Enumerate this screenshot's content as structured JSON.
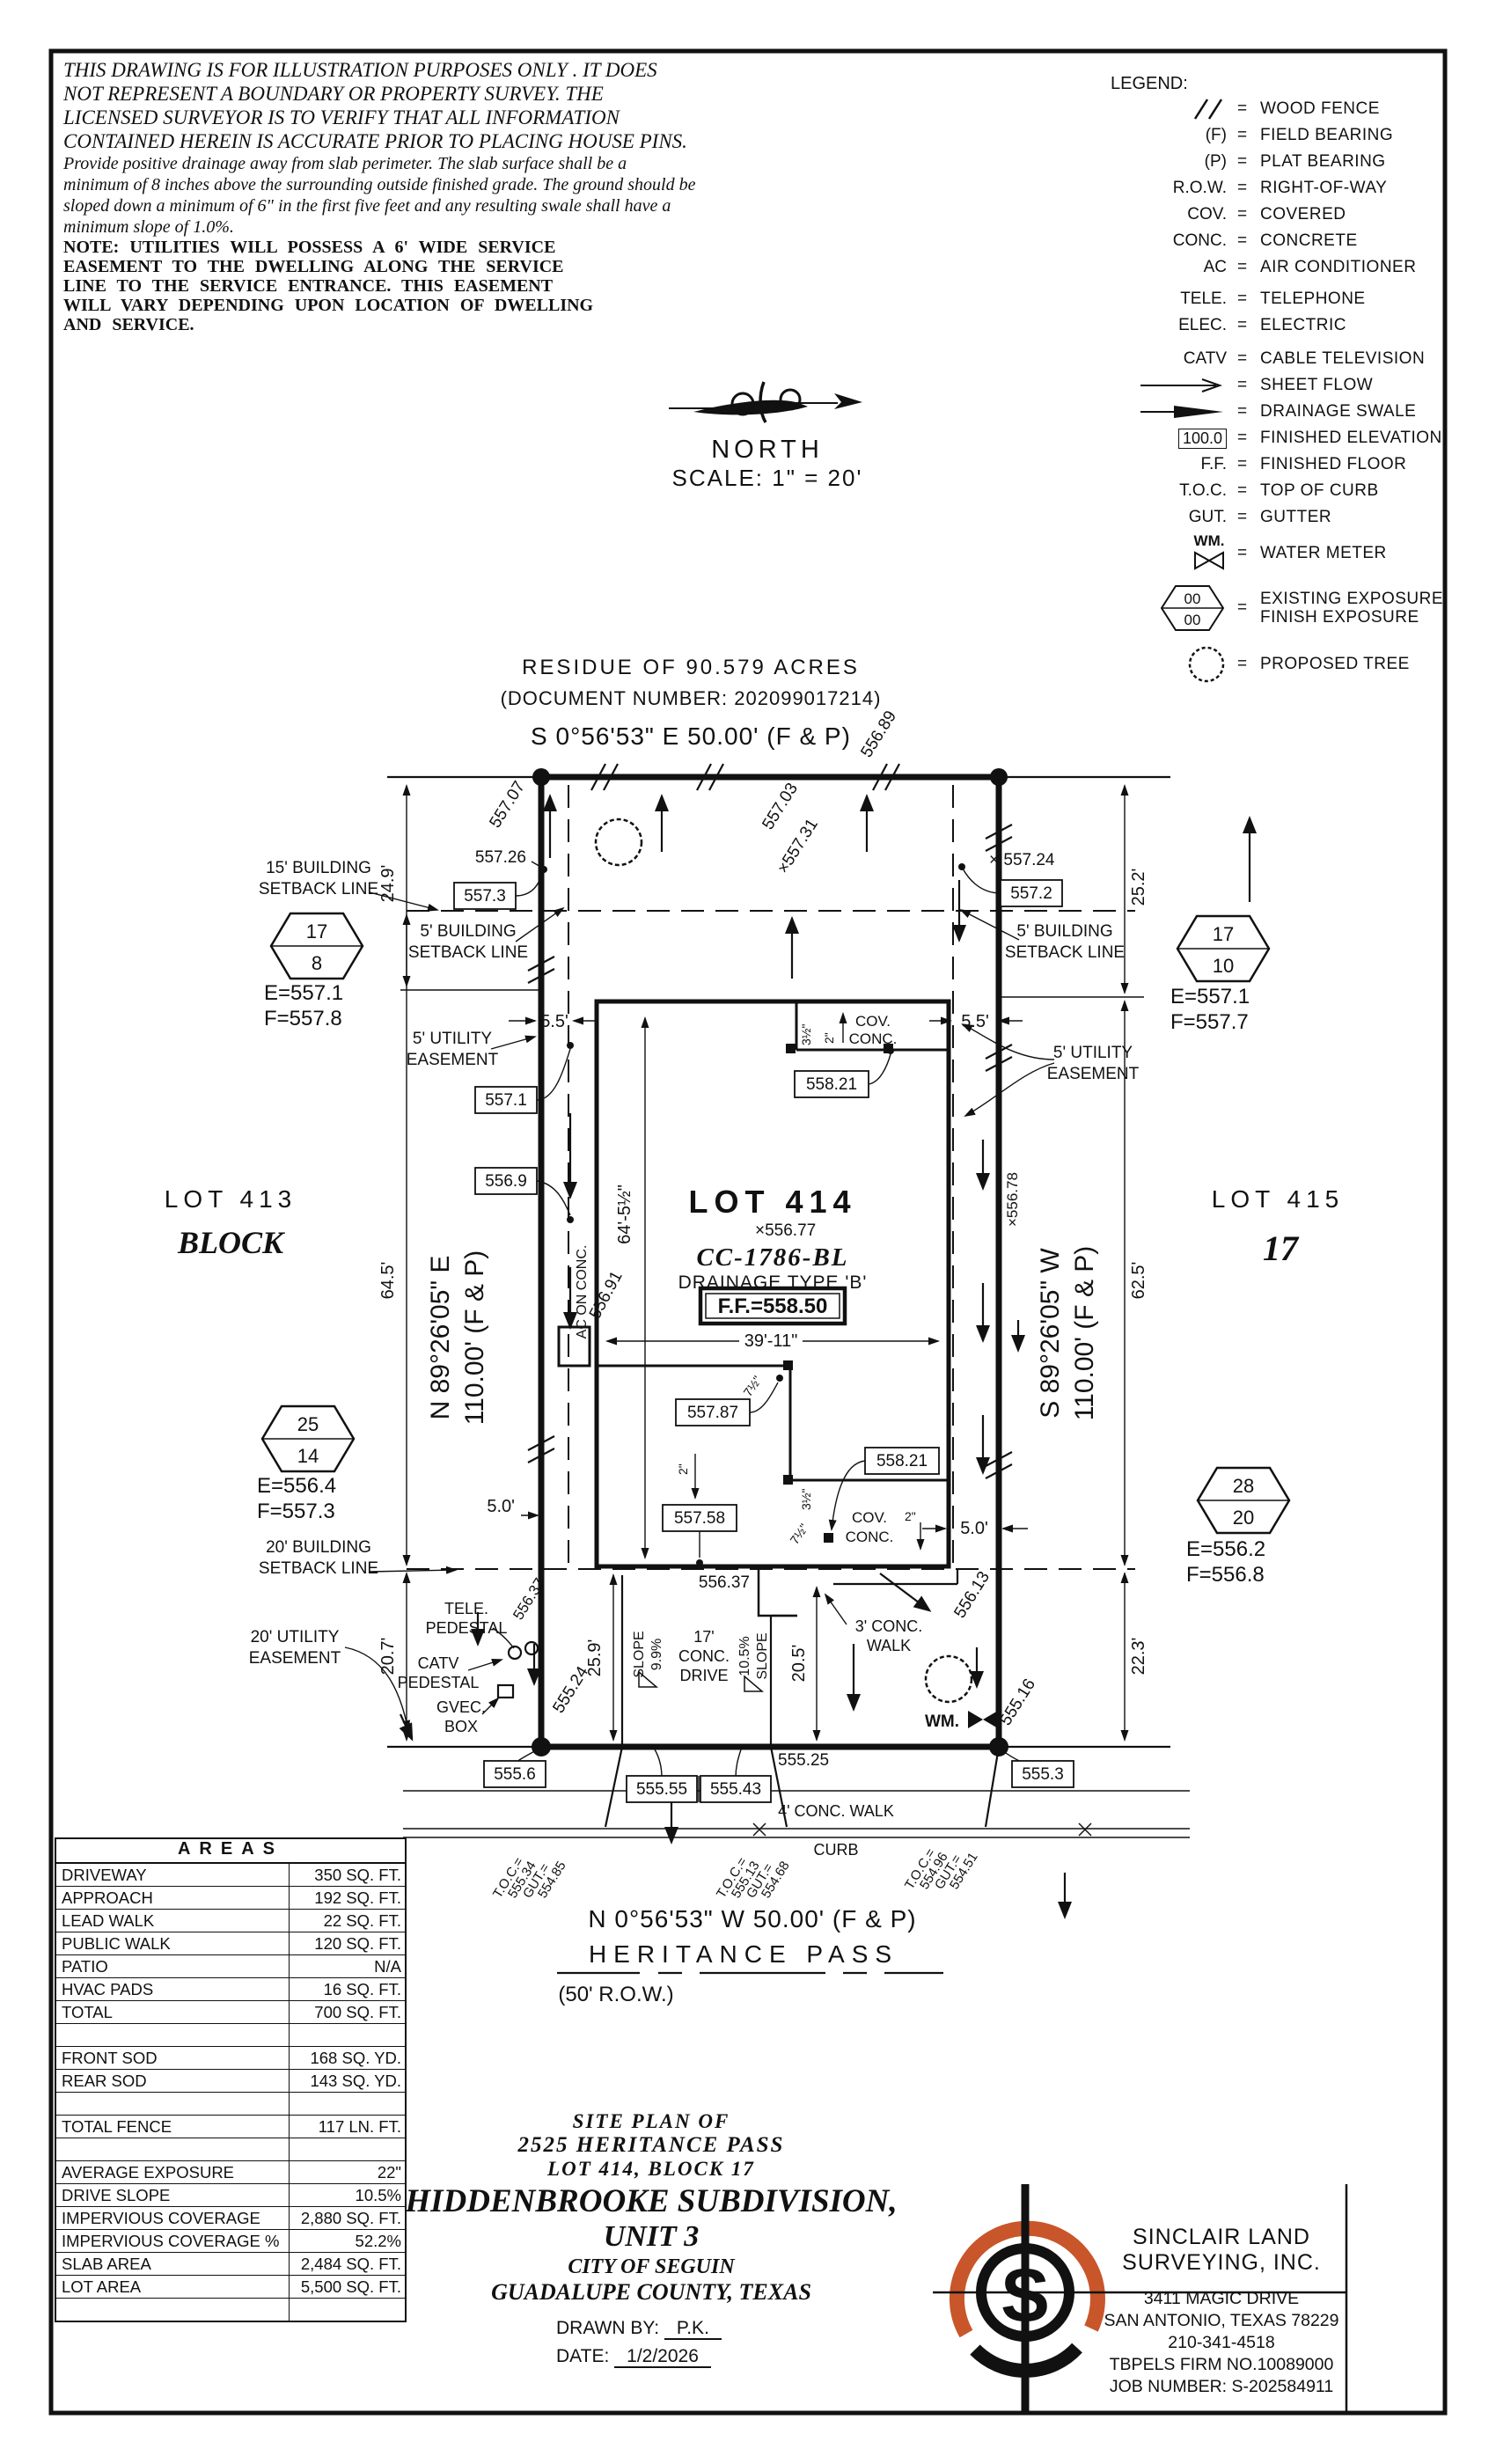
{
  "disclaimer": {
    "p1": [
      "THIS DRAWING IS FOR ILLUSTRATION PURPOSES ONLY . IT DOES",
      "NOT REPRESENT A BOUNDARY OR PROPERTY SURVEY. THE",
      "LICENSED SURVEYOR IS TO VERIFY THAT ALL INFORMATION",
      "CONTAINED HEREIN IS ACCURATE PRIOR TO PLACING HOUSE PINS."
    ],
    "p2": [
      "Provide positive drainage away from slab perimeter. The slab surface shall be a",
      "minimum of 8 inches above the surrounding outside finished grade. The ground should be",
      "sloped down a minimum of 6\" in the first five feet and any resulting swale shall have a",
      "minimum slope of 1.0%."
    ],
    "p3": [
      "NOTE: UTILITIES WILL POSSESS A 6' WIDE SERVICE",
      "EASEMENT TO THE DWELLING ALONG THE SERVICE",
      "LINE TO THE SERVICE ENTRANCE. THIS EASEMENT",
      "WILL VARY DEPENDING UPON LOCATION OF DWELLING",
      "AND SERVICE."
    ]
  },
  "north": {
    "label": "NORTH",
    "scale": "SCALE: 1\" = 20'"
  },
  "legend": {
    "title": "LEGEND:",
    "eq": "=",
    "items": [
      {
        "sym": "",
        "label": "WOOD FENCE"
      },
      {
        "sym": "(F)",
        "label": "FIELD BEARING"
      },
      {
        "sym": "(P)",
        "label": "PLAT BEARING"
      },
      {
        "sym": "R.O.W.",
        "label": "RIGHT-OF-WAY"
      },
      {
        "sym": "COV.",
        "label": "COVERED"
      },
      {
        "sym": "CONC.",
        "label": "CONCRETE"
      },
      {
        "sym": "AC",
        "label": "AIR CONDITIONER"
      },
      {
        "sym": "TELE.",
        "label": "TELEPHONE"
      },
      {
        "sym": "ELEC.",
        "label": "ELECTRIC"
      },
      {
        "sym": "CATV",
        "label": "CABLE TELEVISION"
      },
      {
        "sym": "",
        "label": "SHEET FLOW"
      },
      {
        "sym": "",
        "label": "DRAINAGE SWALE"
      },
      {
        "sym": "100.0",
        "label": "FINISHED ELEVATION"
      },
      {
        "sym": "F.F.",
        "label": "FINISHED FLOOR"
      },
      {
        "sym": "T.O.C.",
        "label": "TOP OF CURB"
      },
      {
        "sym": "GUT.",
        "label": "GUTTER"
      },
      {
        "sym": "WM.",
        "label": "WATER METER"
      },
      {
        "sym": "00",
        "sym2": "00",
        "label": "EXISTING EXPOSURE",
        "label2": "FINISH EXPOSURE"
      },
      {
        "sym": "",
        "label": "PROPOSED TREE"
      }
    ]
  },
  "plat": {
    "header": {
      "residue": "RESIDUE OF 90.579 ACRES",
      "document": "(DOCUMENT NUMBER: 202099017214)"
    },
    "bearings": {
      "top": "S 0°56'53\" E 50.00' (F & P)",
      "bottom": "N 0°56'53\" W 50.00' (F & P)",
      "left1": "N 89°26'05\" E",
      "left2": "110.00' (F & P)",
      "right1": "S 89°26'05\" W",
      "right2": "110.00' (F & P)"
    },
    "street": {
      "name": "HERITANCE PASS",
      "row": "(50' R.O.W.)"
    },
    "lot": {
      "title": "LOT 414",
      "cc": "CC-1786-BL",
      "drainage": "DRAINAGE TYPE 'B'",
      "ff": "F.F.=558.50",
      "spot": "×556.77",
      "width": "39'-11\"",
      "depth": "64'-5½\""
    },
    "neighbors": {
      "left_lot": "LOT 413",
      "left_block": "BLOCK",
      "right_lot": "LOT 415",
      "right_block": "17"
    },
    "hexagons": [
      {
        "top": "17",
        "bottom": "8",
        "e": "E=557.1",
        "f": "F=557.8"
      },
      {
        "top": "17",
        "bottom": "10",
        "e": "E=557.1",
        "f": "F=557.7"
      },
      {
        "top": "25",
        "bottom": "14",
        "e": "E=556.4",
        "f": "F=557.3"
      },
      {
        "top": "28",
        "bottom": "20",
        "e": "E=556.2",
        "f": "F=556.8"
      }
    ],
    "labels": {
      "sb15a": "15' BUILDING",
      "sb15b": "SETBACK LINE",
      "sb5a": "5' BUILDING",
      "sb5b": "SETBACK LINE",
      "sb20a": "20' BUILDING",
      "sb20b": "SETBACK LINE",
      "ue5a": "5' UTILITY",
      "ue5b": "EASEMENT",
      "ue20a": "20' UTILITY",
      "ue20b": "EASEMENT",
      "tele1": "TELE.",
      "tele2": "PEDESTAL",
      "catv1": "CATV",
      "catv2": "PEDESTAL",
      "gvec1": "GVEC.",
      "gvec2": "BOX",
      "wm": "WM.",
      "cov": "COV.",
      "conc": "CONC.",
      "ac": "AC ON CONC.",
      "drive1": "17'",
      "drive2": "CONC.",
      "drive3": "DRIVE",
      "slope_a1": "SLOPE",
      "slope_a2": "9.9%",
      "slope_b1": "10.5%",
      "slope_b2": "SLOPE",
      "walk3a": "3' CONC.",
      "walk3b": "WALK",
      "walk4": "4' CONC. WALK",
      "curb": "CURB",
      "d2": "2\"",
      "d35": "3½\"",
      "d75": "7½\""
    },
    "dims": {
      "v249": "24.9'",
      "v645": "64.5'",
      "v207": "20.7'",
      "v252": "25.2'",
      "v625": "62.5'",
      "v223": "22.3'",
      "v259": "25.9'",
      "v205": "20.5'",
      "h55": "5.5'",
      "h50": "5.0'"
    },
    "spots": {
      "s55689": "556.89",
      "s55707": "557.07",
      "s55726": "557.26",
      "s55703": "557.03",
      "s55731": "×557.31",
      "s55724": "× 557.24",
      "s55691": "556.91",
      "s55678": "×556.78",
      "s55637": "556.37",
      "s55637d": "556.37",
      "s55613": "556.13",
      "s55524": "555.24",
      "s55516": "555.16",
      "s55525": "555.25"
    },
    "boxes": {
      "b5573": "557.3",
      "b5572": "557.2",
      "b5571": "557.1",
      "b5569": "556.9",
      "b55821": "558.21",
      "b55787": "557.87",
      "b55758": "557.58",
      "b55821b": "558.21",
      "b5556": "555.6",
      "b55555": "555.55",
      "b55543": "555.43",
      "b5553": "555.3"
    },
    "toc": [
      {
        "a": "T.O.C.=",
        "b": "555.34",
        "c": "GUT.=",
        "d": "554.85"
      },
      {
        "a": "T.O.C.=",
        "b": "555.13",
        "c": "GUT.=",
        "d": "554.68"
      },
      {
        "a": "T.O.C.=",
        "b": "554.96",
        "c": "GUT.=",
        "d": "554.51"
      }
    ]
  },
  "areas": {
    "title": "AREAS",
    "rows": [
      {
        "label": "DRIVEWAY",
        "value": "350 SQ. FT."
      },
      {
        "label": "APPROACH",
        "value": "192 SQ. FT."
      },
      {
        "label": "LEAD WALK",
        "value": "22 SQ. FT."
      },
      {
        "label": "PUBLIC WALK",
        "value": "120 SQ. FT."
      },
      {
        "label": "PATIO",
        "value": "N/A"
      },
      {
        "label": "HVAC PADS",
        "value": "16 SQ. FT."
      },
      {
        "label": "TOTAL",
        "value": "700 SQ. FT."
      },
      {
        "label": "",
        "value": ""
      },
      {
        "label": "FRONT SOD",
        "value": "168 SQ. YD."
      },
      {
        "label": "REAR SOD",
        "value": "143 SQ. YD."
      },
      {
        "label": "",
        "value": ""
      },
      {
        "label": "TOTAL FENCE",
        "value": "117 LN. FT."
      },
      {
        "label": "",
        "value": ""
      },
      {
        "label": "AVERAGE EXPOSURE",
        "value": "22\""
      },
      {
        "label": "DRIVE SLOPE",
        "value": "10.5%"
      },
      {
        "label": "IMPERVIOUS COVERAGE",
        "value": "2,880 SQ. FT."
      },
      {
        "label": "IMPERVIOUS COVERAGE %",
        "value": "52.2%"
      },
      {
        "label": "SLAB AREA",
        "value": "2,484 SQ. FT."
      },
      {
        "label": "LOT AREA",
        "value": "5,500 SQ. FT."
      },
      {
        "label": "",
        "value": ""
      }
    ]
  },
  "titleblock": {
    "l1": "SITE PLAN OF",
    "l2": "2525 HERITANCE PASS",
    "l3": "LOT 414, BLOCK 17",
    "l4": "HIDDENBROOKE SUBDIVISION,",
    "l5": "UNIT 3",
    "l6": "CITY OF SEGUIN",
    "l7": "GUADALUPE COUNTY, TEXAS",
    "drawn_label": "DRAWN BY:",
    "drawn": "P.K.",
    "date_label": "DATE:",
    "date": "1/2/2026"
  },
  "firm": {
    "name1": "SINCLAIR LAND",
    "name2": "SURVEYING, INC.",
    "addr1": "3411 MAGIC DRIVE",
    "addr2": "SAN ANTONIO, TEXAS 78229",
    "phone": "210-341-4518",
    "reg": "TBPELS FIRM NO.10089000",
    "job": "JOB NUMBER: S-202584911",
    "s": "S",
    "accent": "#c8562a"
  }
}
